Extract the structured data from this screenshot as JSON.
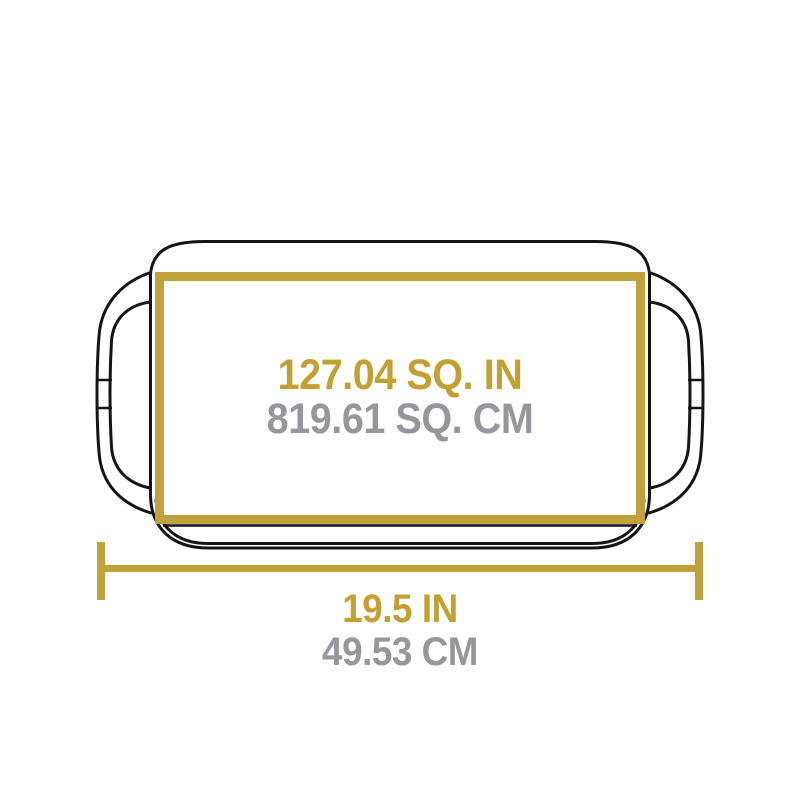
{
  "diagram": {
    "surface_area": {
      "imperial": "127.04 SQ. IN",
      "metric": "819.61 SQ. CM"
    },
    "width": {
      "imperial": "19.5 IN",
      "metric": "49.53 CM"
    }
  },
  "graphics": {
    "outline": "griddle-top-view-outline",
    "highlight": "cooking-surface-rectangle",
    "dimension": "width-dimension-line"
  },
  "colors": {
    "gold": "#BFA23C",
    "text_gold": "#C2A032",
    "text_gray": "#97979B",
    "line": "#141414",
    "background": "#FFFFFF"
  }
}
